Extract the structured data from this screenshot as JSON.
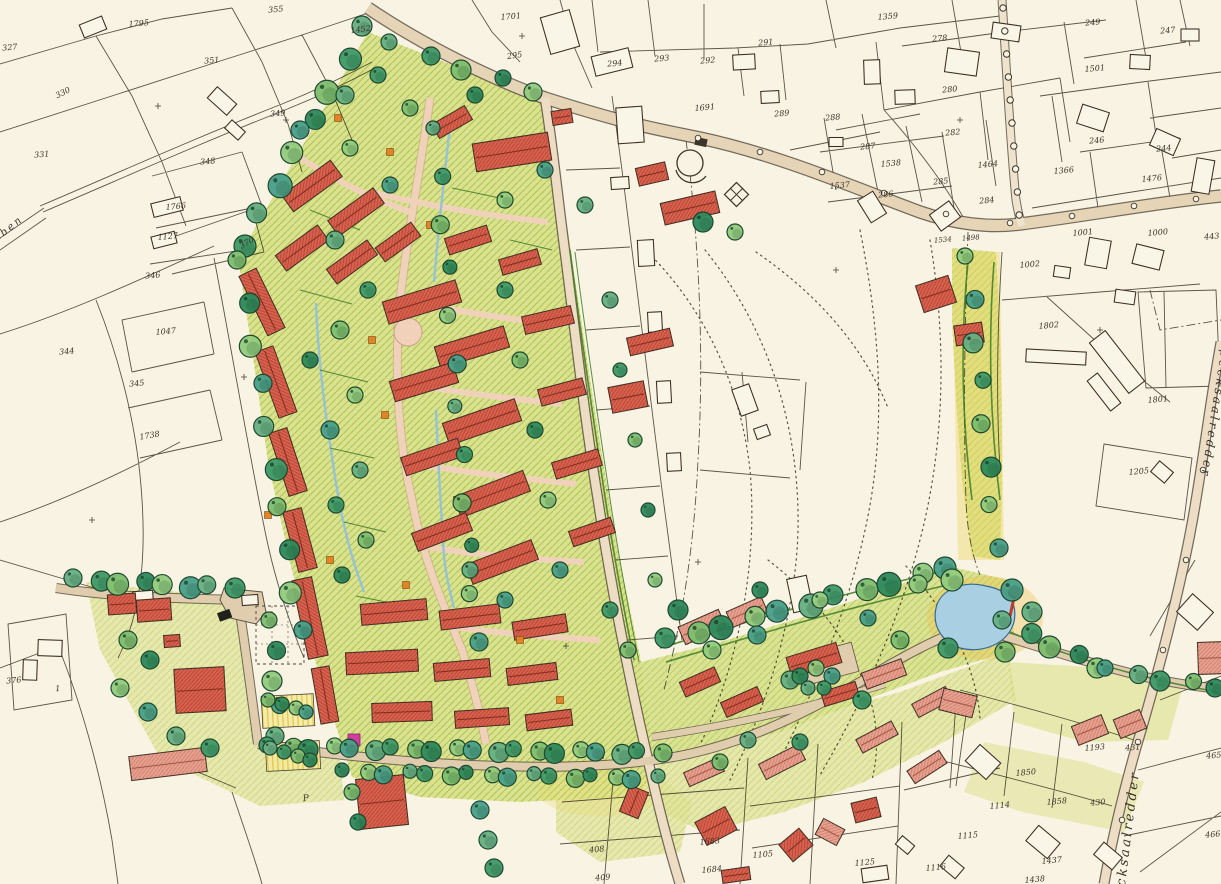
{
  "map": {
    "description": "hand-colored urban development site plan on cadastral base map",
    "street_labels": [
      {
        "text": "Specksaalredder",
        "x": 1212,
        "y": 408,
        "rot": 99,
        "size": 12
      },
      {
        "text": "Specksaalredder",
        "x": 1130,
        "y": 845,
        "rot": -83,
        "size": 13
      },
      {
        "text": "graben",
        "x": 4,
        "y": 236,
        "rot": -39,
        "size": 10
      }
    ],
    "poi_labels": [
      {
        "text": "P",
        "x": 306,
        "y": 801,
        "size": 9
      }
    ],
    "road_labels": [
      {
        "text": "1534",
        "x": 943,
        "y": 242,
        "rot": -5
      },
      {
        "text": "1498",
        "x": 971,
        "y": 240,
        "rot": -5
      }
    ],
    "parcel_labels": [
      {
        "text": "327",
        "x": 10,
        "y": 50
      },
      {
        "text": "1795",
        "x": 139,
        "y": 26
      },
      {
        "text": "351",
        "x": 212,
        "y": 63
      },
      {
        "text": "355",
        "x": 276,
        "y": 12
      },
      {
        "text": "1452",
        "x": 361,
        "y": 32,
        "rot": -8
      },
      {
        "text": "330",
        "x": 64,
        "y": 95,
        "rot": -26
      },
      {
        "text": "349",
        "x": 278,
        "y": 116
      },
      {
        "text": "331",
        "x": 42,
        "y": 157
      },
      {
        "text": "348",
        "x": 208,
        "y": 164
      },
      {
        "text": "1766",
        "x": 176,
        "y": 209
      },
      {
        "text": "1127",
        "x": 168,
        "y": 239
      },
      {
        "text": "346",
        "x": 153,
        "y": 278
      },
      {
        "text": "344",
        "x": 67,
        "y": 354
      },
      {
        "text": "1047",
        "x": 166,
        "y": 334
      },
      {
        "text": "345",
        "x": 137,
        "y": 386
      },
      {
        "text": "1738",
        "x": 150,
        "y": 438,
        "rot": -10
      },
      {
        "text": "370",
        "x": 248,
        "y": 245,
        "rot": -30
      },
      {
        "text": "376",
        "x": 14,
        "y": 683
      },
      {
        "text": "1",
        "x": 58,
        "y": 691
      },
      {
        "text": "1701",
        "x": 511,
        "y": 19
      },
      {
        "text": "295",
        "x": 515,
        "y": 58,
        "rot": -8
      },
      {
        "text": "294",
        "x": 615,
        "y": 66
      },
      {
        "text": "293",
        "x": 662,
        "y": 61
      },
      {
        "text": "292",
        "x": 708,
        "y": 63
      },
      {
        "text": "291",
        "x": 766,
        "y": 45
      },
      {
        "text": "1691",
        "x": 705,
        "y": 110
      },
      {
        "text": "289",
        "x": 782,
        "y": 116
      },
      {
        "text": "1359",
        "x": 888,
        "y": 19
      },
      {
        "text": "278",
        "x": 940,
        "y": 41
      },
      {
        "text": "249",
        "x": 1093,
        "y": 25
      },
      {
        "text": "247",
        "x": 1168,
        "y": 33
      },
      {
        "text": "1501",
        "x": 1095,
        "y": 71
      },
      {
        "text": "280",
        "x": 950,
        "y": 92
      },
      {
        "text": "288",
        "x": 833,
        "y": 120
      },
      {
        "text": "282",
        "x": 953,
        "y": 135
      },
      {
        "text": "287",
        "x": 868,
        "y": 149
      },
      {
        "text": "1538",
        "x": 891,
        "y": 166
      },
      {
        "text": "285",
        "x": 941,
        "y": 184
      },
      {
        "text": "1537",
        "x": 840,
        "y": 188
      },
      {
        "text": "286",
        "x": 886,
        "y": 197
      },
      {
        "text": "1464",
        "x": 988,
        "y": 167
      },
      {
        "text": "284",
        "x": 987,
        "y": 203
      },
      {
        "text": "246",
        "x": 1097,
        "y": 143
      },
      {
        "text": "244",
        "x": 1164,
        "y": 151
      },
      {
        "text": "1366",
        "x": 1064,
        "y": 173
      },
      {
        "text": "1476",
        "x": 1152,
        "y": 181
      },
      {
        "text": "1001",
        "x": 1083,
        "y": 235
      },
      {
        "text": "1000",
        "x": 1158,
        "y": 235
      },
      {
        "text": "443",
        "x": 1212,
        "y": 239
      },
      {
        "text": "1002",
        "x": 1030,
        "y": 267
      },
      {
        "text": "1802",
        "x": 1049,
        "y": 328
      },
      {
        "text": "1801",
        "x": 1158,
        "y": 402
      },
      {
        "text": "1205",
        "x": 1139,
        "y": 474
      },
      {
        "text": "1193",
        "x": 1095,
        "y": 750
      },
      {
        "text": "431",
        "x": 1133,
        "y": 750
      },
      {
        "text": "1850",
        "x": 1026,
        "y": 775
      },
      {
        "text": "1114",
        "x": 1000,
        "y": 808
      },
      {
        "text": "1858",
        "x": 1057,
        "y": 804
      },
      {
        "text": "430",
        "x": 1098,
        "y": 805
      },
      {
        "text": "1115",
        "x": 968,
        "y": 838
      },
      {
        "text": "1116",
        "x": 936,
        "y": 870
      },
      {
        "text": "1437",
        "x": 1052,
        "y": 863
      },
      {
        "text": "1438",
        "x": 1035,
        "y": 882
      },
      {
        "text": "465",
        "x": 1214,
        "y": 758
      },
      {
        "text": "466",
        "x": 1213,
        "y": 837
      },
      {
        "text": "1105",
        "x": 763,
        "y": 857
      },
      {
        "text": "1125",
        "x": 865,
        "y": 865
      },
      {
        "text": "1683",
        "x": 710,
        "y": 844
      },
      {
        "text": "1684",
        "x": 712,
        "y": 872
      },
      {
        "text": "408",
        "x": 597,
        "y": 852
      },
      {
        "text": "409",
        "x": 603,
        "y": 880
      }
    ],
    "colors": {
      "paper": "#f8f3e3",
      "ink": "#3c352a",
      "roof_red": "#d96250",
      "roof_pink": "#e8a291",
      "lawn_green": "#dcea93",
      "tree_green": "#4f9e6d",
      "road_tan": "#e6d4b6",
      "street_pink": "#f0d2ba",
      "water_blue": "#a9cfe3",
      "accent_yellow": "#f3dd6e",
      "accent_magenta": "#cf3f9e",
      "accent_orange": "#e08427"
    }
  }
}
